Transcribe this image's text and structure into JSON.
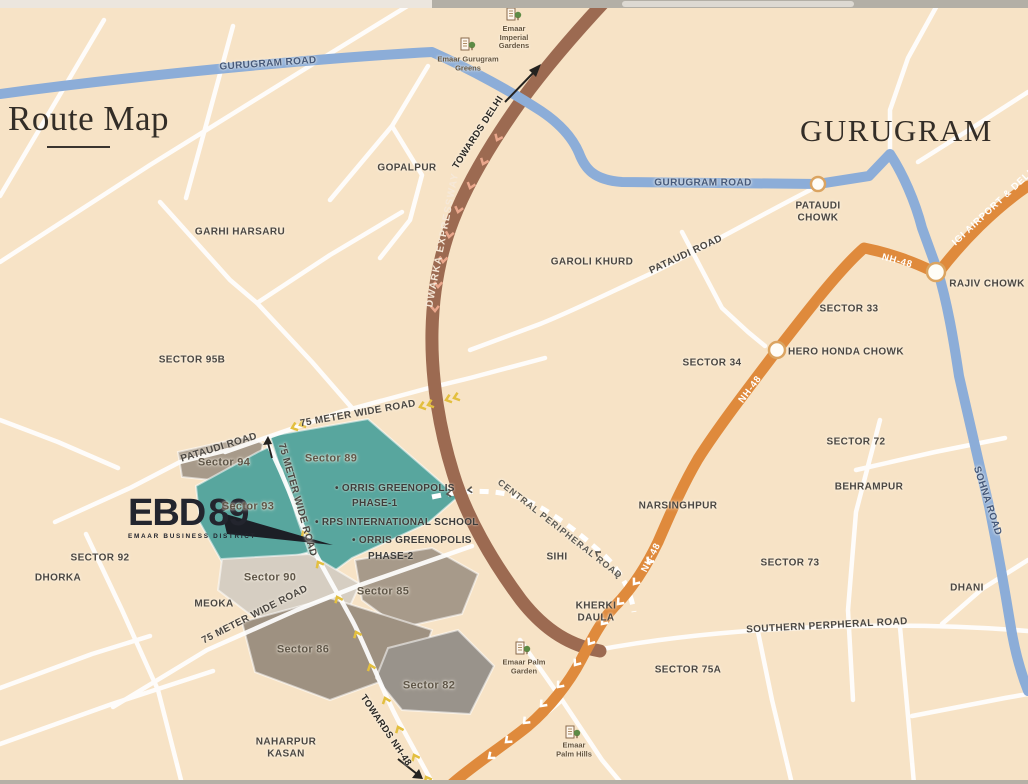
{
  "titles": {
    "route_map": "Route Map",
    "city": "GURUGRAM"
  },
  "logo": {
    "name": "EBD",
    "number": "89",
    "tagline": "EMAAR BUSINESS DISTRICT"
  },
  "roads": {
    "gurugram_road": "GURUGRAM ROAD",
    "pataudi_road": "PATAUDI ROAD",
    "dwarka_expressway": "DWARKA EXPRESSWAY",
    "towards_delhi": "TOWARDS DELHI",
    "nh48": "NH-48",
    "igi_airport_delhi": "IGI AIRPORT & DELHI",
    "sohna_road": "SOHNA ROAD",
    "meter_75_wide": "75 METER WIDE ROAD",
    "central_peripheral": "CENTRAL PERIPHERAL ROAD",
    "southern_peripheral": "SOUTHERN PERPHERAL ROAD",
    "towards_nh48": "TOWARDS NH-48"
  },
  "junctions": {
    "pataudi_chowk": "PATAUDI CHOWK",
    "rajiv_chowk": "RAJIV CHOWK",
    "hero_honda_chowk": "HERO HONDA CHOWK",
    "kherki_daula": "KHERKI DAULA"
  },
  "places": {
    "gopalpur": "GOPALPUR",
    "garhi_harsaru": "GARHI HARSARU",
    "garoli_khurd": "GAROLI KHURD",
    "narsinghpur": "NARSINGHPUR",
    "behrampur": "BEHRAMPUR",
    "sihi": "SIHI",
    "dhani": "DHANI",
    "dhorka": "DHORKA",
    "meoka": "MEOKA",
    "naharpur_kasan": "NAHARPUR KASAN"
  },
  "sectors": {
    "s95b": "SECTOR 95B",
    "s92": "SECTOR 92",
    "s33": "SECTOR 33",
    "s34": "SECTOR 34",
    "s72": "SECTOR 72",
    "s73": "SECTOR 73",
    "s75a": "SECTOR 75A",
    "s94": "Sector 94",
    "s89": "Sector 89",
    "s93": "Sector 93",
    "s90": "Sector 90",
    "s85": "Sector 85",
    "s86": "Sector 86",
    "s82": "Sector 82"
  },
  "landmarks": {
    "imperial_gardens": "Emaar Imperial Gardens",
    "gurugram_greens": "Emaar Gurugram Greens",
    "palm_garden": "Emaar Palm Garden",
    "palm_hills": "Emaar Palm Hills"
  },
  "pois": {
    "orris_phase1_line1": "• ORRIS GREENOPOLIS",
    "orris_phase1_line2": "PHASE-1",
    "rps_school": "• RPS INTERNATIONAL SCHOOL",
    "orris_phase2_line1": "• ORRIS GREENOPOLIS",
    "orris_phase2_line2": "PHASE-2"
  },
  "colors": {
    "background": "#f7e3c6",
    "road_blue": "#8cadd8",
    "road_orange": "#df8a3c",
    "road_brown": "#9c6a51",
    "sector_teal": "#58a69e",
    "sector_taupe": "#a79a8a",
    "sector_light_gray": "#d6cec2",
    "sector_dark_taupe": "#9e9181",
    "sector_gray": "#99938b"
  }
}
